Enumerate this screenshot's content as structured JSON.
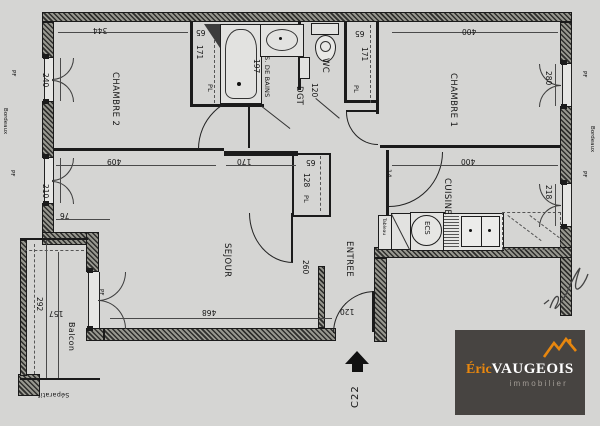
{
  "rooms": {
    "chambre2": "CHAMBRE 2",
    "chambre1": "CHAMBRE 1",
    "sejour": "SEJOUR",
    "entree": "ENTREE",
    "cuisine": "CUISINE",
    "salle_de_bains": "S. DE BAINS",
    "wc": "WC",
    "dgt": "DGT",
    "balcon": "Balcon",
    "placard": "PL"
  },
  "dims": {
    "ch2_width": "344",
    "ch2_window": "240",
    "sejour_window": "210",
    "ch1_width": "400",
    "ch1_window": "280",
    "cuisine_width": "400",
    "cuisine_window": "218",
    "pl_left_depth": "65",
    "pl_left_width": "171",
    "pl_right_depth": "65",
    "pl_right_width": "171",
    "pl_center_depth": "65",
    "pl_center_width": "128",
    "bains_width": "197",
    "dgt_width": "120",
    "sejour_length": "409",
    "sejour_top": "170",
    "sejour_bottom": "468",
    "entree_width": "260",
    "door_width": "120",
    "balcon_length": "292",
    "balcon_width": "157",
    "sejour_offset": "76",
    "cuisine_wall": "14"
  },
  "annotations": {
    "bordeaux": "Bordeaux",
    "separatif": "Séparatif",
    "pf": "PF",
    "tableau": "Tableau",
    "ecs": "ECS",
    "unit": "C22"
  },
  "logo": {
    "brand_first": "Éric",
    "brand_last": "VAUGEOIS",
    "tagline": "immobilier"
  },
  "colors": {
    "paper": "#d5d5d3",
    "line": "#1b1b1b",
    "wall": "#3a3a3a",
    "logo_bg": "#474441",
    "logo_orange": "#e8870e",
    "logo_text": "#ffffff",
    "logo_tagline": "#a39d96"
  }
}
